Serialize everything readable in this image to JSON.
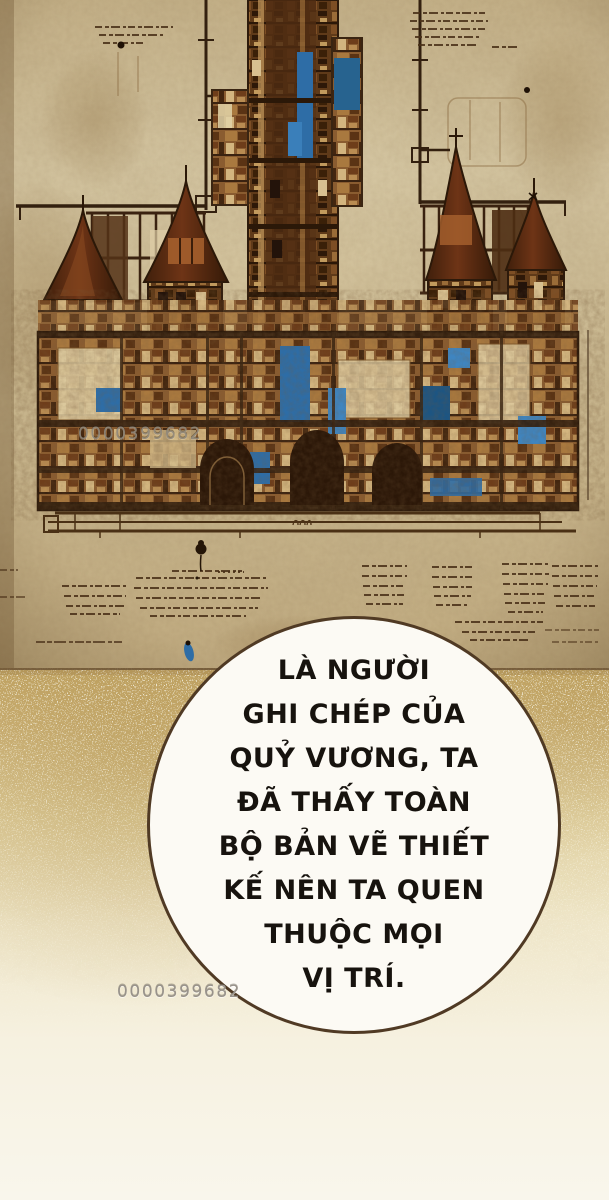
{
  "dialog": {
    "lines": [
      "LÀ NGƯỜI",
      "GHI CHÉP CỦA",
      "QUỶ VƯƠNG, TA",
      "ĐÃ THẤY TOÀN",
      "BỘ BẢN VẼ THIẾT",
      "KẾ NÊN TA QUEN",
      "THUỘC MỌI",
      "VỊ TRÍ."
    ],
    "full_text": "LÀ NGƯỜI GHI CHÉP CỦA QUỶ VƯƠNG, TA ĐÃ THẤY TOÀN BỘ BẢN VẼ THIẾT KẾ NÊN TA QUEN THUỘC MỌI VỊ TRÍ."
  },
  "watermark": {
    "text": "0000399682",
    "occurrences": 2
  },
  "colors": {
    "parchment": "#cfbd96",
    "ink_dark": "#33200f",
    "castle_brown": "#7a4a22",
    "castle_rust": "#6b3018",
    "blueprint_blue": "#2e6da6",
    "gold_texture": "#c2a565",
    "page_cream": "#f7f3e8",
    "bubble_fill": "#fcfaf4",
    "bubble_border": "#503a24",
    "dialog_text": "#17130e",
    "watermark_gray": "#98928a"
  }
}
